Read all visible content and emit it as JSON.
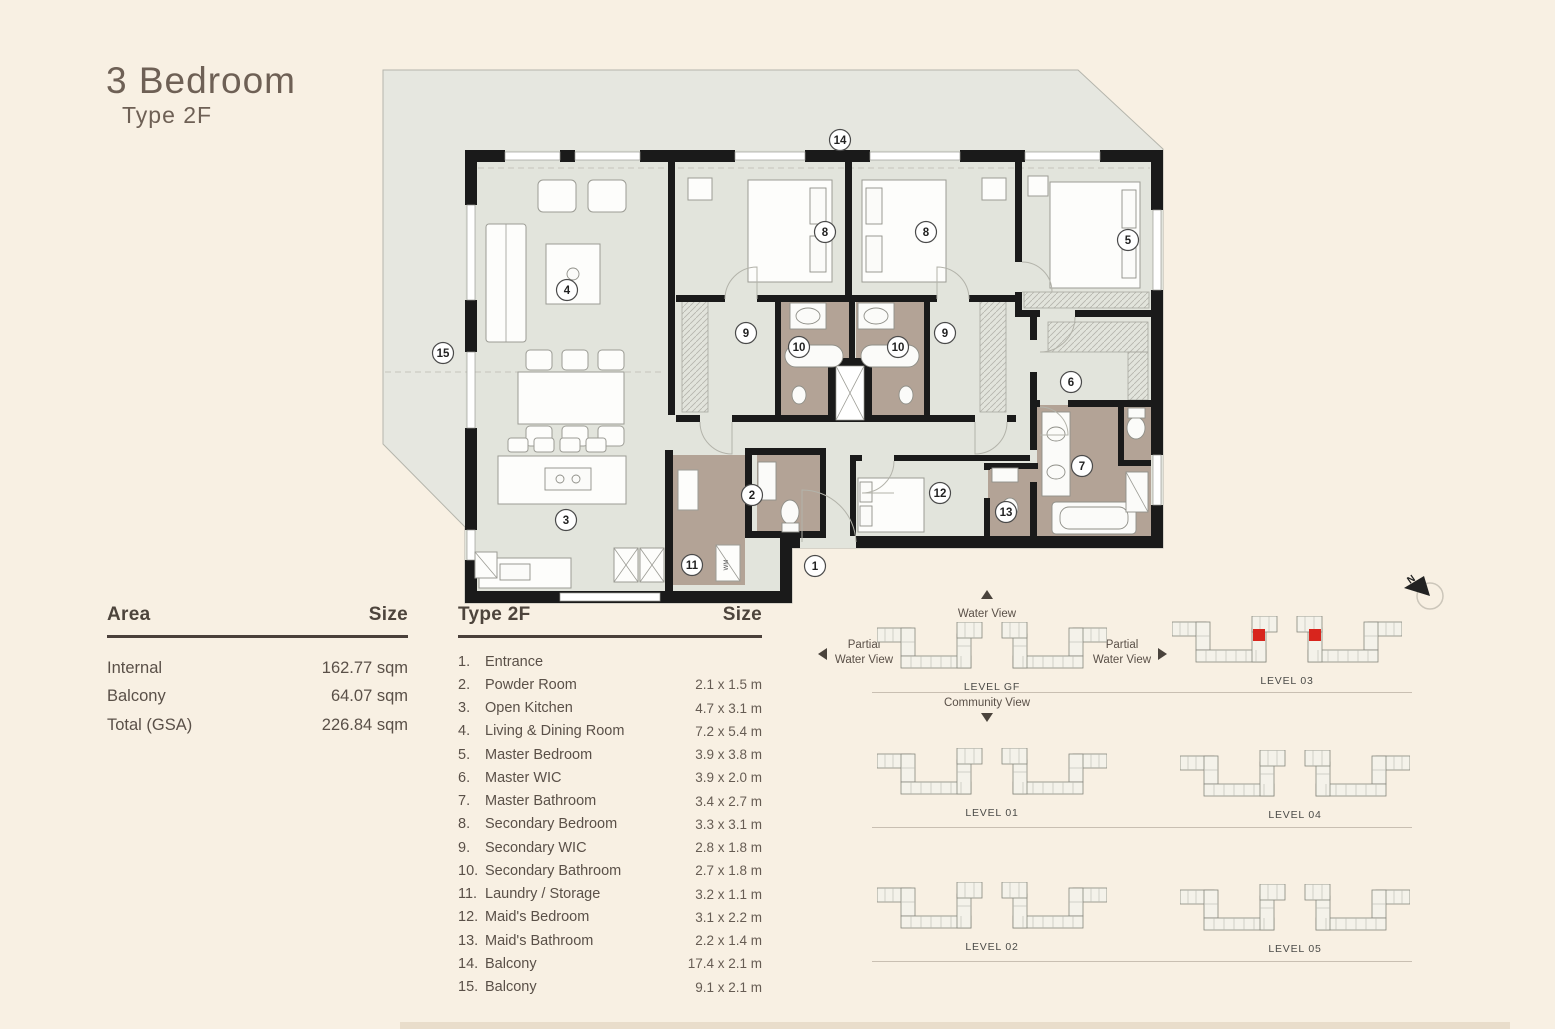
{
  "header": {
    "title": "3 Bedroom",
    "subtitle": "Type 2F"
  },
  "area_table": {
    "col_label": "Area",
    "col_size": "Size",
    "rows": [
      {
        "label": "Internal",
        "value": "162.77 sqm"
      },
      {
        "label": "Balcony",
        "value": "64.07 sqm"
      },
      {
        "label": "Total (GSA)",
        "value": "226.84 sqm"
      }
    ]
  },
  "rooms_table": {
    "col_label": "Type 2F",
    "col_size": "Size",
    "rows": [
      {
        "num": "1.",
        "label": "Entrance",
        "size": ""
      },
      {
        "num": "2.",
        "label": "Powder Room",
        "size": "2.1 x 1.5 m"
      },
      {
        "num": "3.",
        "label": "Open Kitchen",
        "size": "4.7 x 3.1 m"
      },
      {
        "num": "4.",
        "label": "Living & Dining Room",
        "size": "7.2 x 5.4 m"
      },
      {
        "num": "5.",
        "label": "Master Bedroom",
        "size": "3.9 x 3.8 m"
      },
      {
        "num": "6.",
        "label": "Master WIC",
        "size": "3.9 x 2.0 m"
      },
      {
        "num": "7.",
        "label": "Master Bathroom",
        "size": "3.4 x 2.7 m"
      },
      {
        "num": "8.",
        "label": "Secondary Bedroom",
        "size": "3.3 x 3.1 m"
      },
      {
        "num": "9.",
        "label": "Secondary WIC",
        "size": "2.8 x 1.8 m"
      },
      {
        "num": "10.",
        "label": "Secondary Bathroom",
        "size": "2.7 x 1.8 m"
      },
      {
        "num": "11.",
        "label": "Laundry / Storage",
        "size": "3.2 x 1.1 m"
      },
      {
        "num": "12.",
        "label": "Maid's Bedroom",
        "size": "3.1 x 2.2 m"
      },
      {
        "num": "13.",
        "label": "Maid's Bathroom",
        "size": "2.2 x 1.4 m"
      },
      {
        "num": "14.",
        "label": "Balcony",
        "size": "17.4 x 2.1 m"
      },
      {
        "num": "15.",
        "label": "Balcony",
        "size": "9.1 x 2.1 m"
      }
    ]
  },
  "floorplan": {
    "unit_labels": [
      {
        "n": "1",
        "x": 815,
        "y": 566
      },
      {
        "n": "2",
        "x": 752,
        "y": 495
      },
      {
        "n": "3",
        "x": 566,
        "y": 520
      },
      {
        "n": "4",
        "x": 567,
        "y": 290
      },
      {
        "n": "5",
        "x": 1128,
        "y": 240
      },
      {
        "n": "6",
        "x": 1071,
        "y": 382
      },
      {
        "n": "7",
        "x": 1082,
        "y": 466
      },
      {
        "n": "8",
        "x": 825,
        "y": 232
      },
      {
        "n": "8",
        "x": 926,
        "y": 232
      },
      {
        "n": "9",
        "x": 746,
        "y": 333
      },
      {
        "n": "9",
        "x": 945,
        "y": 333
      },
      {
        "n": "10",
        "x": 799,
        "y": 347
      },
      {
        "n": "10",
        "x": 898,
        "y": 347
      },
      {
        "n": "11",
        "x": 692,
        "y": 565
      },
      {
        "n": "12",
        "x": 940,
        "y": 493
      },
      {
        "n": "13",
        "x": 1006,
        "y": 512
      },
      {
        "n": "14",
        "x": 840,
        "y": 140
      },
      {
        "n": "15",
        "x": 443,
        "y": 353
      }
    ],
    "appliance_label": "WM",
    "colors": {
      "wall": "#1a1a1a",
      "floor": "#e2e4dc",
      "balcony": "#e6e7e0",
      "bathroom": "#b3a396"
    }
  },
  "keyplan": {
    "water_view": "Water View",
    "partial_water_view_left": "Partial Water View",
    "partial_water_view_right": "Partial Water View",
    "community_view": "Community View",
    "highlight_color": "#d8251d",
    "levels": [
      {
        "label": "LEVEL GF",
        "highlight": false
      },
      {
        "label": "LEVEL 03",
        "highlight": true
      },
      {
        "label": "LEVEL 01",
        "highlight": false
      },
      {
        "label": "LEVEL 04",
        "highlight": false
      },
      {
        "label": "LEVEL 02",
        "highlight": false
      },
      {
        "label": "LEVEL 05",
        "highlight": false
      }
    ]
  },
  "compass": {
    "label": "N"
  }
}
